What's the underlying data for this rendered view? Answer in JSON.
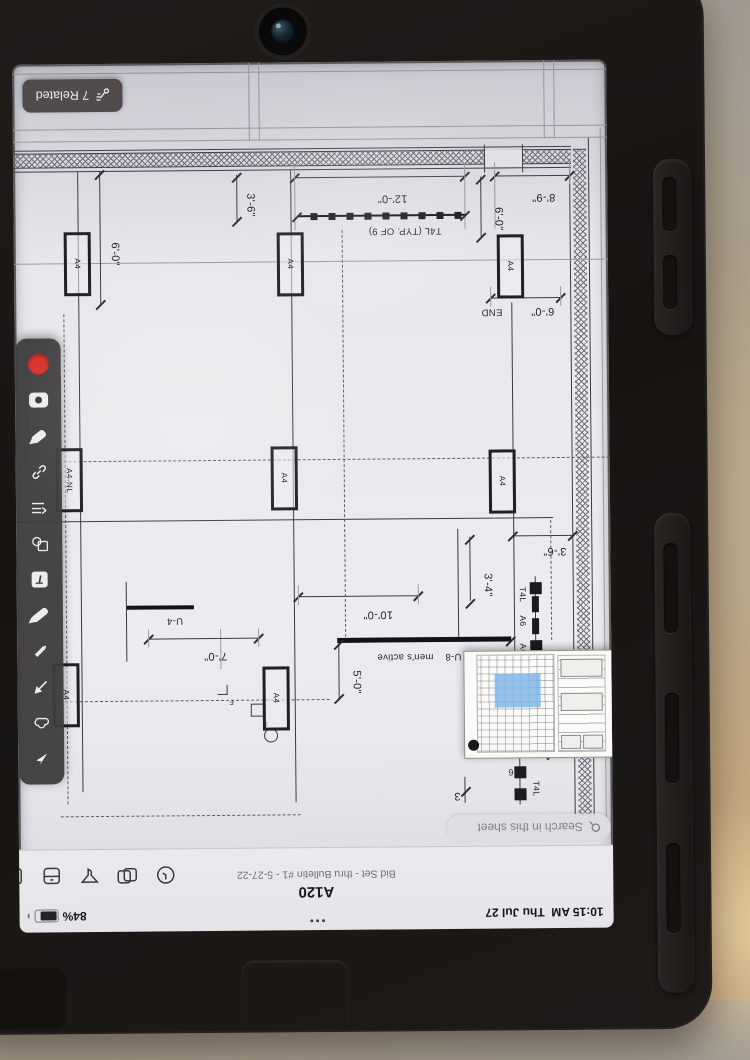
{
  "status": {
    "time": "10:15 AM",
    "date": "Thu Jul 27",
    "battery": "84%",
    "dots": "•••"
  },
  "header": {
    "sheet_number": "A120",
    "sheet_version": "Bid Set - thru Bulletin #1 - 5-27-22",
    "search_placeholder": "Search in this sheet",
    "action_icons": [
      "history-clock-icon",
      "compare-versions-icon",
      "filter-funnel-icon",
      "sheet-drawer-icon",
      "more-tools-icon"
    ]
  },
  "related": {
    "label": "7 Related"
  },
  "toolbar": {
    "tools": [
      "select-arrow",
      "cloud-markup",
      "arrow-annotation",
      "pen",
      "highlighter",
      "text",
      "shapes",
      "callout-list",
      "hyperlink",
      "marker",
      "photo-camera",
      "record-issue"
    ],
    "record_color": "#d8342c"
  },
  "plan": {
    "dims": {
      "d12_0": "12'-0\"",
      "d3_6a": "3'-6\"",
      "d8_9": "8'-9\"",
      "d6_0a": "6'-0\"",
      "d6_0b": "6'-0\"",
      "d6_0c": "6'-0\"",
      "d7_0": "7'-0\"",
      "d10_0": "10'-0\"",
      "d5_0": "5'-0\"",
      "d3_4": "3'-4\"",
      "d3_6b": "3'-6\"",
      "d3": "3"
    },
    "labels": {
      "t4l_typ": "T4L (TYP. OF 9)",
      "end": "END",
      "u4": "U-4",
      "u8": "U-8",
      "mens_active": "men's active",
      "t4l": "T4L",
      "a6": "A6",
      "six": "6",
      "a4": "A4",
      "a4nl": "A4-NL",
      "f": "F"
    }
  }
}
